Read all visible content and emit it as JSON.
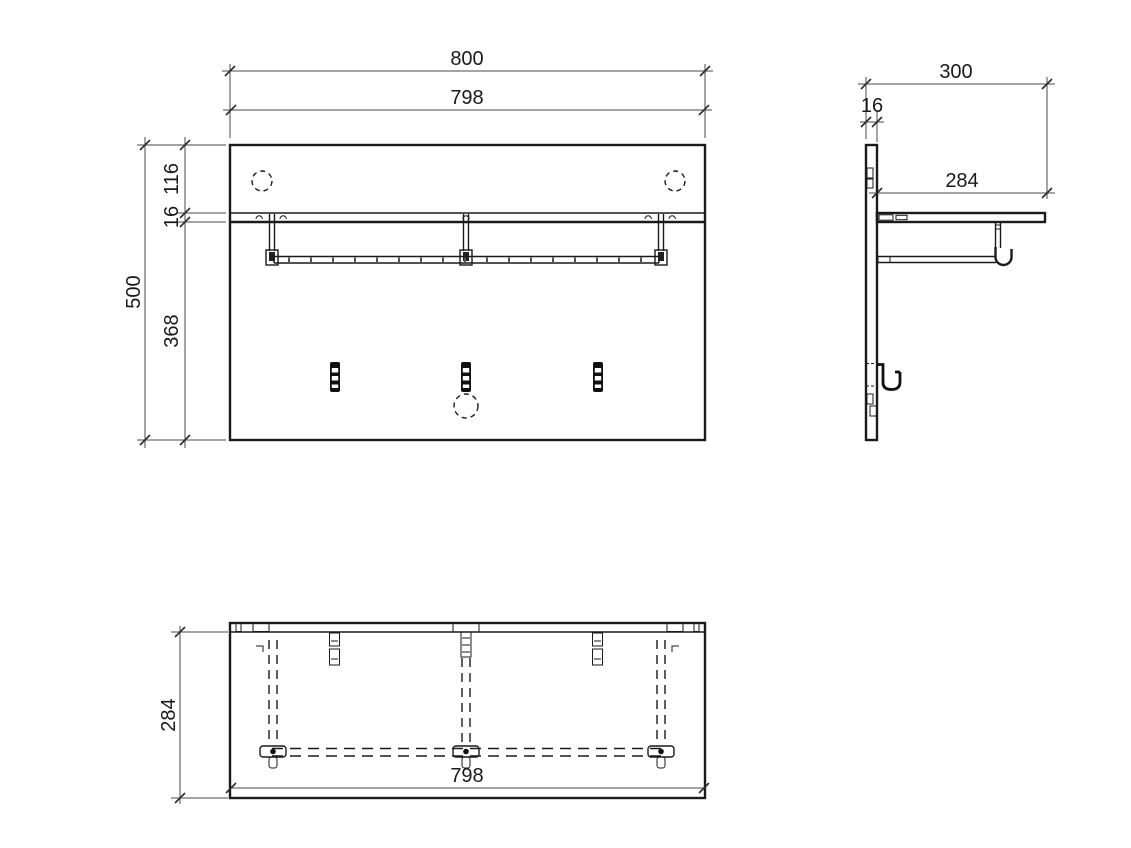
{
  "drawing": {
    "type": "cad-orthographic-technical-drawing",
    "subject": "wall-mounted coat rack panel with shelf, hanging rail and hooks",
    "background": "#ffffff",
    "line_color": "#1a1a1a",
    "dimension_color": "#4a4a4a",
    "dims": {
      "front": {
        "total_width": "800",
        "shelf_width": "798",
        "top_to_shelf": "116",
        "shelf_thickness": "16",
        "below_shelf": "368",
        "total_height": "500"
      },
      "side": {
        "total_depth": "300",
        "panel_thickness": "16",
        "shelf_depth": "284"
      },
      "bottom": {
        "depth": "284",
        "shelf_width": "798"
      }
    }
  }
}
